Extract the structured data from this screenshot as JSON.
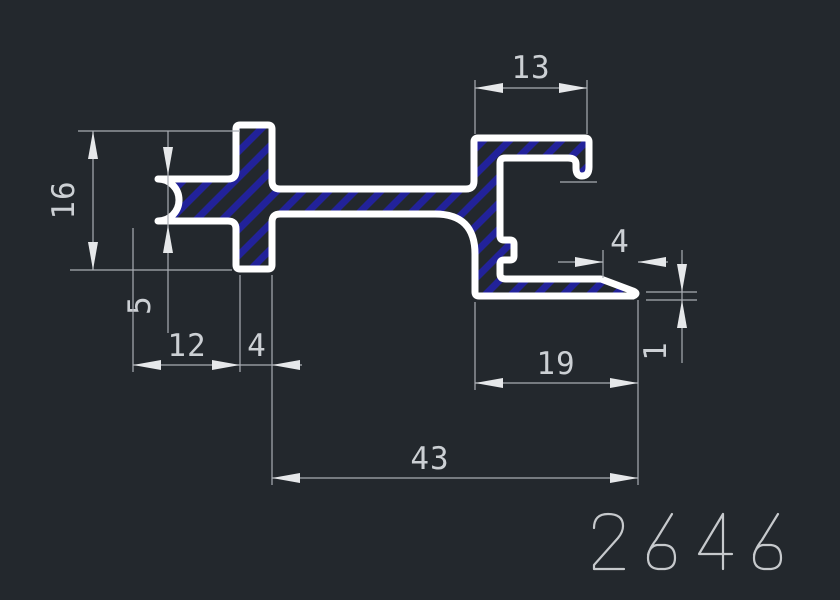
{
  "drawing": {
    "type": "cad-profile-cross-section",
    "part_number": "2646",
    "dimensions": {
      "hook_width": "13",
      "left_height": "16",
      "lip_thickness": "5",
      "lip_length": "12",
      "stem_width": "4",
      "flange_length": "19",
      "tip_taper": "4",
      "tip_thickness": "1",
      "overall_length": "43"
    },
    "colors": {
      "background": "#23282d",
      "profile_outline": "#ffffff",
      "section_hatch": "#22229a",
      "dimension_lines": "#a9adb3",
      "dimension_text": "#ccd0d4",
      "arrowheads": "#e6e8ea"
    }
  }
}
